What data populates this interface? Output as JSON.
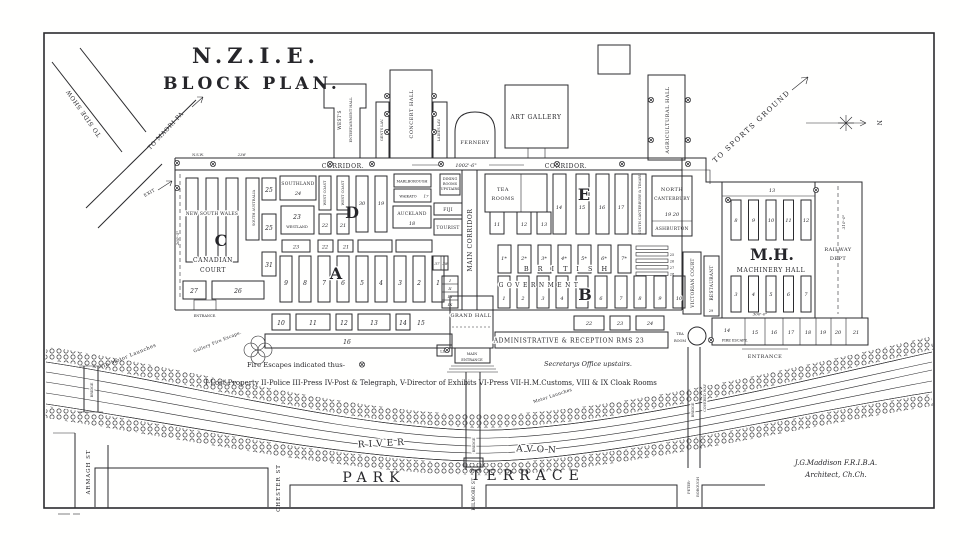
{
  "colors": {
    "ink": "#2b2b2e",
    "paper": "#fffffe"
  },
  "title": {
    "l1": "N.Z.I.E.",
    "l2": "BLOCK PLAN."
  },
  "compass": {
    "n": "N"
  },
  "roads": {
    "side_show": "TO SIDE SHOW",
    "maori_pa": "TO MAORI PA",
    "exit": "EXIT",
    "sports": "TO SPORTS GROUND"
  },
  "annex": {
    "wests1": "WEST'S",
    "wests2": "ENTERTAINMENT HALL",
    "gents": "GENTS LAV.",
    "concert": "CONCERT HALL",
    "ladies": "LADIES LAV.",
    "fernery": "FERNERY",
    "art": "ART GALLERY",
    "agri": "AGRICULTURAL HALL"
  },
  "corridor": {
    "left": "CORRIDOR.",
    "right": "CORRIDOR.",
    "dim": "1002'-6\"",
    "nsw": "N.S.W.",
    "dim236": "236'",
    "main": "MAIN CORRIDOR"
  },
  "sections": {
    "a": "A",
    "b": "B",
    "c": "C",
    "d": "D",
    "e": "E",
    "mh": "M.H."
  },
  "west": {
    "nsw": "NEW SOUTH WALES",
    "sa": "SOUTH AUSTRALIA",
    "n25a": "25",
    "n25b": "25",
    "n31": "31",
    "n27": "27",
    "n26": "26",
    "canadian1": "CANADIAN",
    "canadian2": "COURT",
    "entrance": "ENTRANCE.",
    "dim": "260'-5\"",
    "southland": "SOUTHLAND",
    "southland_n": "24",
    "n23": "23",
    "westland": "WESTLAND",
    "wc1": "WEST COAST",
    "wc2": "WEST COAST",
    "n22": "22",
    "n21": "21",
    "n30": "30",
    "n19": "19",
    "marl": "MARLBOROUGH",
    "waikato": "WAIKATO",
    "n17": "17",
    "auckland": "AUCKLAND",
    "n18": "18",
    "fiji": "FIJI",
    "tourist": "TOURIST",
    "dining1": "DINING",
    "dining2": "ROOMS",
    "dining3": "UPSTAIRS",
    "mid": [
      "23",
      "22",
      "21"
    ],
    "a_stalls": [
      "9",
      "8",
      "7",
      "6",
      "5",
      "4",
      "3",
      "2",
      "1"
    ],
    "small": [
      "37",
      "38"
    ],
    "roman": [
      "I",
      "II",
      "III",
      "IX"
    ],
    "bottom": [
      "10",
      "11",
      "12",
      "13",
      "14",
      "15"
    ],
    "bottom_long": "16"
  },
  "east": {
    "tea1": "TEA",
    "tea2": "ROOMS",
    "stalls_a": [
      "11",
      "12",
      "13"
    ],
    "stalls_b": [
      "14",
      "15",
      "16",
      "17"
    ],
    "sct": "SOUTH CANTERBURY & TIMARU",
    "nc1": "NORTH",
    "nc2": "CANTERBURY",
    "nc_n": "19   20",
    "ashburton": "ASHBURTON",
    "british": "BRITISH",
    "brit_stalls": [
      "1*",
      "2*",
      "3*",
      "4*",
      "5*",
      "6*",
      "7*"
    ],
    "government": "GOVERNMENT",
    "gov_stalls": [
      "1",
      "2",
      "3",
      "4",
      "6",
      "7",
      "8",
      "9",
      "10"
    ],
    "side_bars": [
      "25",
      "26",
      "27",
      "28"
    ],
    "bottom": [
      "22",
      "23",
      "24"
    ]
  },
  "center": {
    "grand": "GRAND HALL",
    "lift": "LIFT",
    "me1": "MAIN",
    "me2": "ENTRANCE",
    "admin": "ADMINISTRATIVE & RECEPTION RMS 23",
    "victorian": "VICTORIAN COURT",
    "restaurant": "RESTAURANT",
    "rest_n": "29",
    "tearoom1": "TEA",
    "tearoom2": "ROOM"
  },
  "mh": {
    "name": "MACHINERY HALL",
    "railway1": "RAILWAY",
    "railway2": "DEPT",
    "n13": "13",
    "top": [
      "8",
      "9",
      "10",
      "11",
      "12"
    ],
    "mid": [
      "3",
      "4",
      "5",
      "6",
      "7"
    ],
    "bottom": [
      "14",
      "15",
      "16",
      "17",
      "18",
      "19",
      "20",
      "21"
    ],
    "dimv": "310'-0\"",
    "dimh": "300'-0\"",
    "fire": "FIRE ESCAPE.",
    "entrance": "ENTRANCE"
  },
  "notes": {
    "fire": "Fire Escapes indicated thus-",
    "secretary": "Secretarys Office upstairs.",
    "legend": "I-Lost Property  II-Police  III-Press  IV-Post & Telegraph, V-Director of Exhibits  VI-Press  VII-H.M.Customs, VIII & IX Cloak Rooms",
    "gallery": "Gallery Fire Escape.",
    "launches": "To Motor Launches",
    "launches2": "Motor Launches"
  },
  "river": {
    "river": "RIVER",
    "avon": "AVON",
    "bridge1": "BRIDGE",
    "bridge2": "BRIDGE",
    "bridge3": "BRIDGE",
    "covered": "COVERED WAY"
  },
  "streets": {
    "park": "PARK",
    "terrace": "TERRACE",
    "armagh": "ARMAGH ST",
    "chester": "CHESTER ST",
    "kilmore": "KILMORE ST",
    "peter1": "PETER-",
    "peter2": "BOROUGH"
  },
  "sign": {
    "l1": "J.G.Maddison F.R.I.B.A.",
    "l2": "Architect, Ch.Ch."
  }
}
